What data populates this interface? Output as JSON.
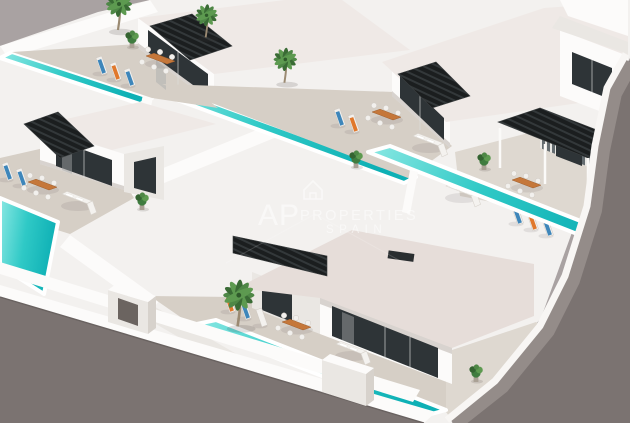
{
  "scene": {
    "description": "Aerial 3D architectural render of a modern white villa development with private turquoise pools, beige sun terraces, black slatted pergolas and palm trees, bounded by grey streets",
    "style": "isometric real-estate visualization"
  },
  "watermark": {
    "brand": "AP",
    "brand_word": "PROPERTIES",
    "region": "SPAIN",
    "logo": "house-outline-icon"
  },
  "inventory": {
    "villas_visible": 6,
    "two_storey_villas": 1,
    "pools_visible": 5,
    "pergolas": 5,
    "sun_loungers": 14,
    "dining_sets": 5,
    "corner_sofas": 4,
    "palm_trees": 4
  },
  "colors": {
    "backdrop": "#a9a2a2",
    "road": "#7b7371",
    "road_light": "#948c89",
    "white_base": "#f3f1ef",
    "wall_bright": "#fcfbfa",
    "wall_shade": "#eae7e3",
    "wall_dark": "#d7d2cc",
    "roof_surface": "#e6ddd9",
    "roof_light": "#efe9e6",
    "terrace": "#d6cfc6",
    "terrace_light": "#ded8d0",
    "pool_deep": "#0eb0b5",
    "pool_mid": "#2fc9c6",
    "pool_light": "#8ae8e3",
    "glass_dark": "#2e3437",
    "pergola_dark": "#1b1e1f",
    "table_wood": "#c5773a",
    "towel_blue": "#3e86ba",
    "towel_orange": "#e0782c",
    "sofa_white": "#f4f2ef",
    "plant_green": "#3f7c3f",
    "palm_green": "#4e8746",
    "watermark": "#ffffff"
  }
}
